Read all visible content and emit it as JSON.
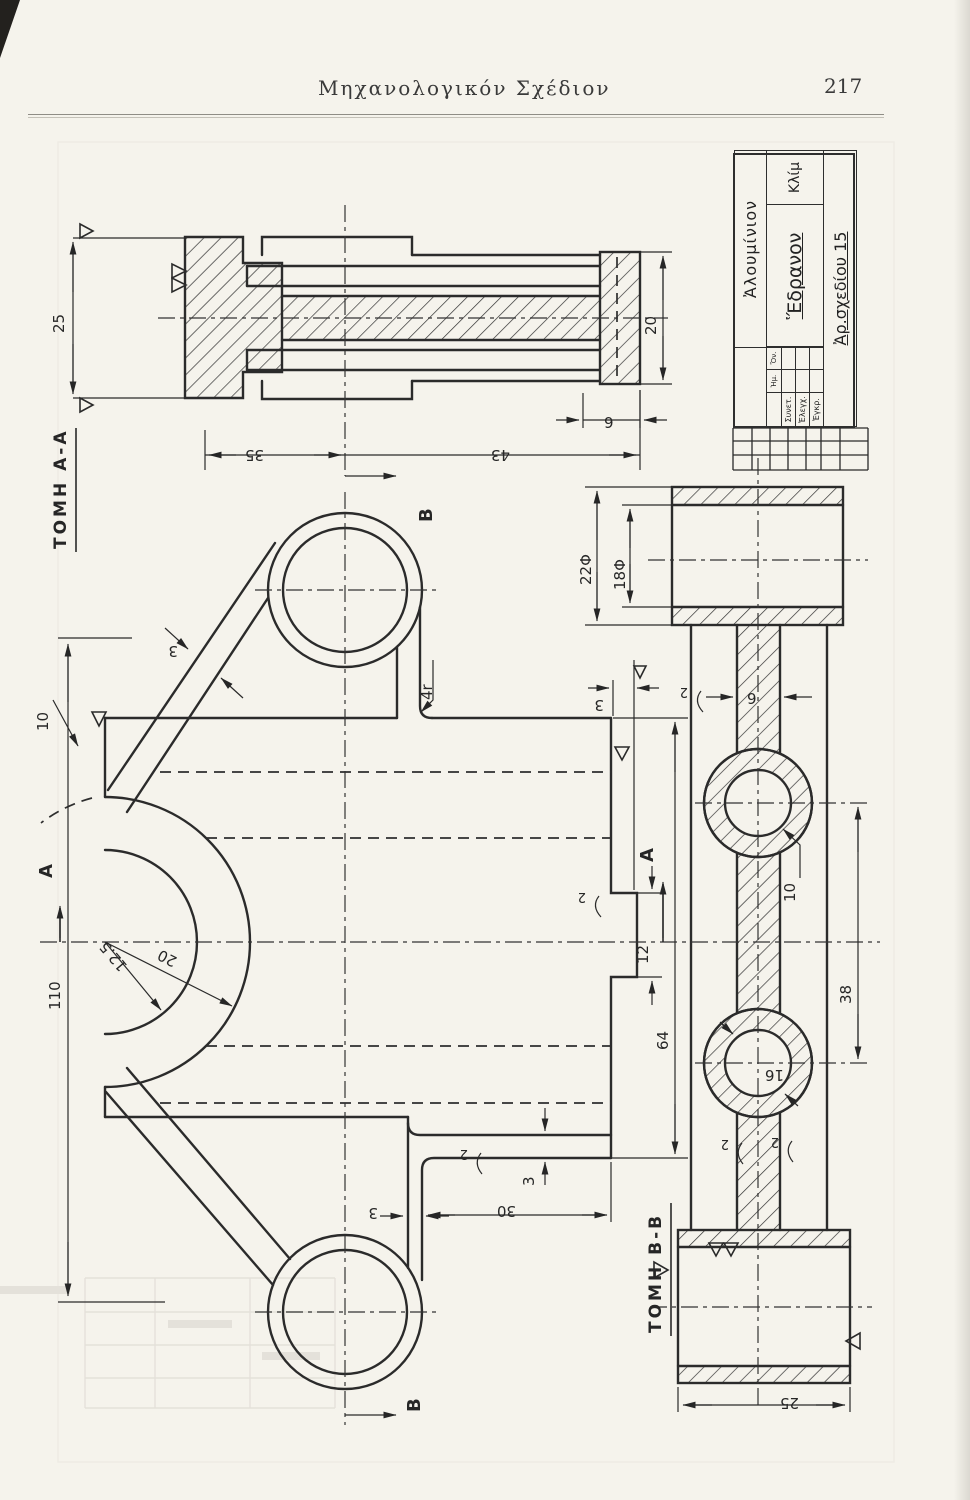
{
  "t": {
    "title": "Μηχανολογικόν Σχέδιον",
    "page": "217",
    "tomh_a": "ΤΟΜΗ Α-Α",
    "tomh_b": "ΤΟΜΗ Β-Β",
    "A": "A",
    "B": "B",
    "d25": "25",
    "d35": "35",
    "d43": "43",
    "d20": "20",
    "d9": "9",
    "d110": "110",
    "d10": "10",
    "r125": "12.5",
    "r20": "20",
    "d3": "3",
    "d4r": "4r",
    "d2": "2",
    "d12": "12",
    "d64": "64",
    "d30": "30",
    "d22": "22Φ",
    "d18": "18Φ",
    "d38": "38",
    "d16": "16",
    "mat": "Ἀλουμίνιον",
    "part": "Ἕδρανον",
    "klim": "Κλίμ",
    "arsx": "Ἀρ.σχεδίου 15",
    "r1": "Συνετ.",
    "r2": "Ἐλεγχ.",
    "r3": "Ἐγκρ.",
    "h1": "Ἡμ.",
    "h2": "Ὄν."
  }
}
